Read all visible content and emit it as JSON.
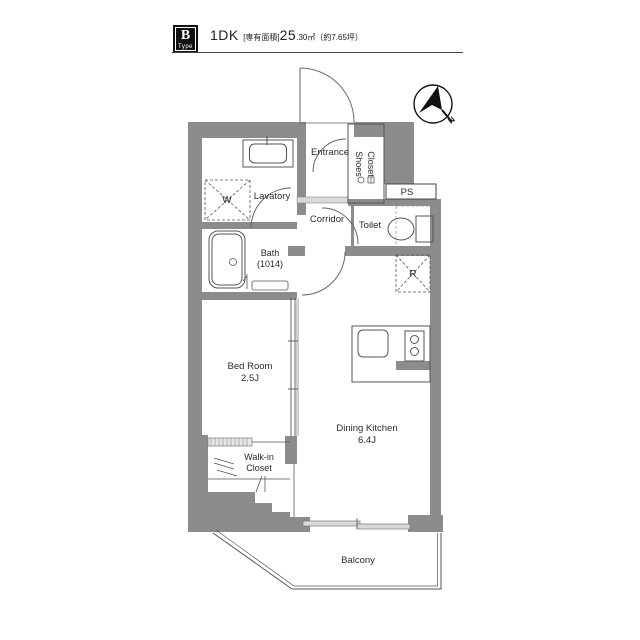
{
  "header": {
    "badge_letter": "B",
    "badge_type": "Type",
    "plan_type": "1DK",
    "area_prefix": "[専有面積]",
    "area_value": "25",
    "area_suffix": ".30㎡",
    "area_tsubo": "（約7.65坪）"
  },
  "compass": {
    "label": "N"
  },
  "rooms": {
    "entrance": {
      "label": "Entrance"
    },
    "shoes_closet": {
      "line1": "Shoes",
      "line2": "Closet"
    },
    "lavatory": {
      "label": "Lavatory"
    },
    "corridor": {
      "label": "Corridor"
    },
    "toilet": {
      "label": "Toilet"
    },
    "ps": {
      "label": "PS"
    },
    "bath": {
      "label": "Bath",
      "size": "(1014)"
    },
    "bedroom": {
      "label": "Bed Room",
      "size": "2.5J"
    },
    "dining_kitchen": {
      "label": "Dining Kitchen",
      "size": "6.4J"
    },
    "walkin_closet": {
      "line1": "Walk-in",
      "line2": "Closet"
    },
    "balcony": {
      "label": "Balcony"
    }
  },
  "symbols": {
    "washer": "W",
    "refrigerator": "R"
  },
  "colors": {
    "wall_gray": "#8c8c8c",
    "light_gray": "#d8d8d8",
    "line": "#555555"
  }
}
